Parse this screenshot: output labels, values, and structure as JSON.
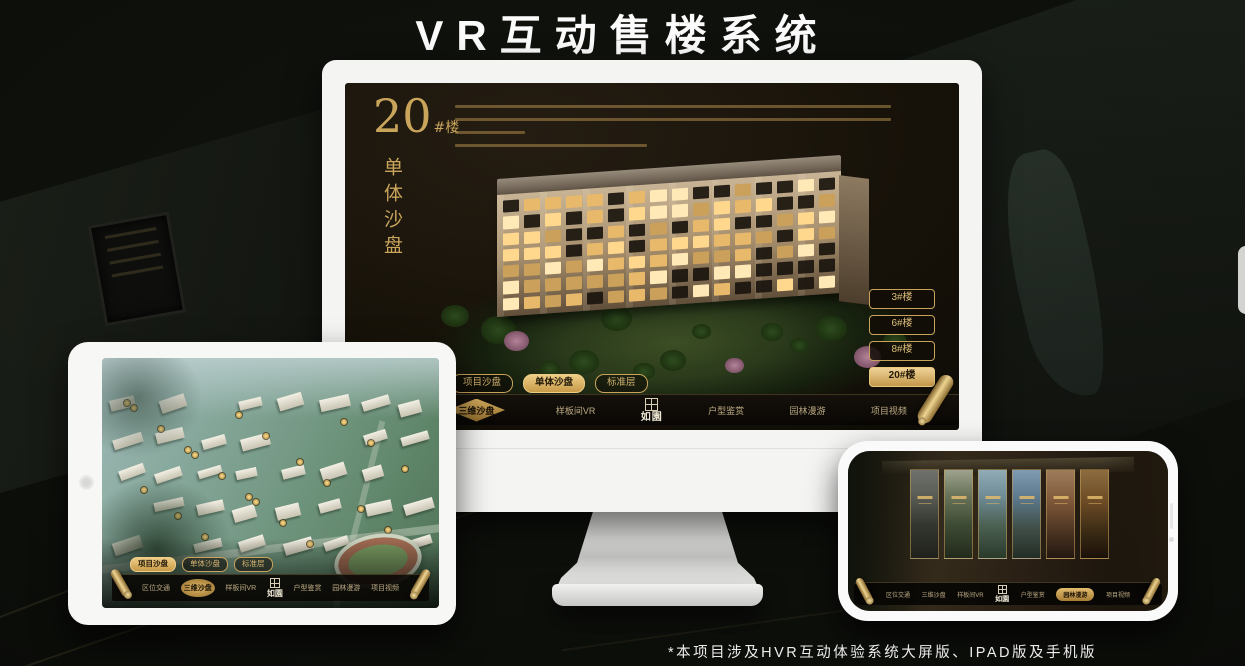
{
  "title": "VR互动售楼系统",
  "footnote": "*本项目涉及HVR互动体验系统大屏版、IPAD版及手机版",
  "brand": {
    "logo_text": "如園"
  },
  "colors": {
    "gold": "#c9a45b",
    "gold_bright": "#eecd86",
    "screen_bg": "#171209",
    "nav_bg": "#0c0a07",
    "window_lit": "#ffd88e"
  },
  "nav_items": [
    "区位交通",
    "三维沙盘",
    "样板间VR",
    "户型鉴赏",
    "园林漫游",
    "项目视频"
  ],
  "monitor": {
    "headline_number": "20",
    "headline_suffix": "#楼",
    "headline_vertical": "单体沙盘",
    "sub_tabs": [
      "项目沙盘",
      "单体沙盘",
      "标准层"
    ],
    "active_sub_tab": "单体沙盘",
    "floor_buttons": [
      "3#楼",
      "6#楼",
      "8#楼",
      "20#楼"
    ],
    "active_floor_button": "20#楼",
    "active_nav_item": "三维沙盘"
  },
  "tablet": {
    "sub_tabs": [
      "项目沙盘",
      "单体沙盘",
      "标准层"
    ],
    "active_sub_tab": "项目沙盘",
    "active_nav_item": "三维沙盘"
  },
  "phone": {
    "active_nav_item": "园林漫游"
  },
  "icons": [
    "scroll-icon",
    "seal-icon",
    "camera-icon"
  ]
}
